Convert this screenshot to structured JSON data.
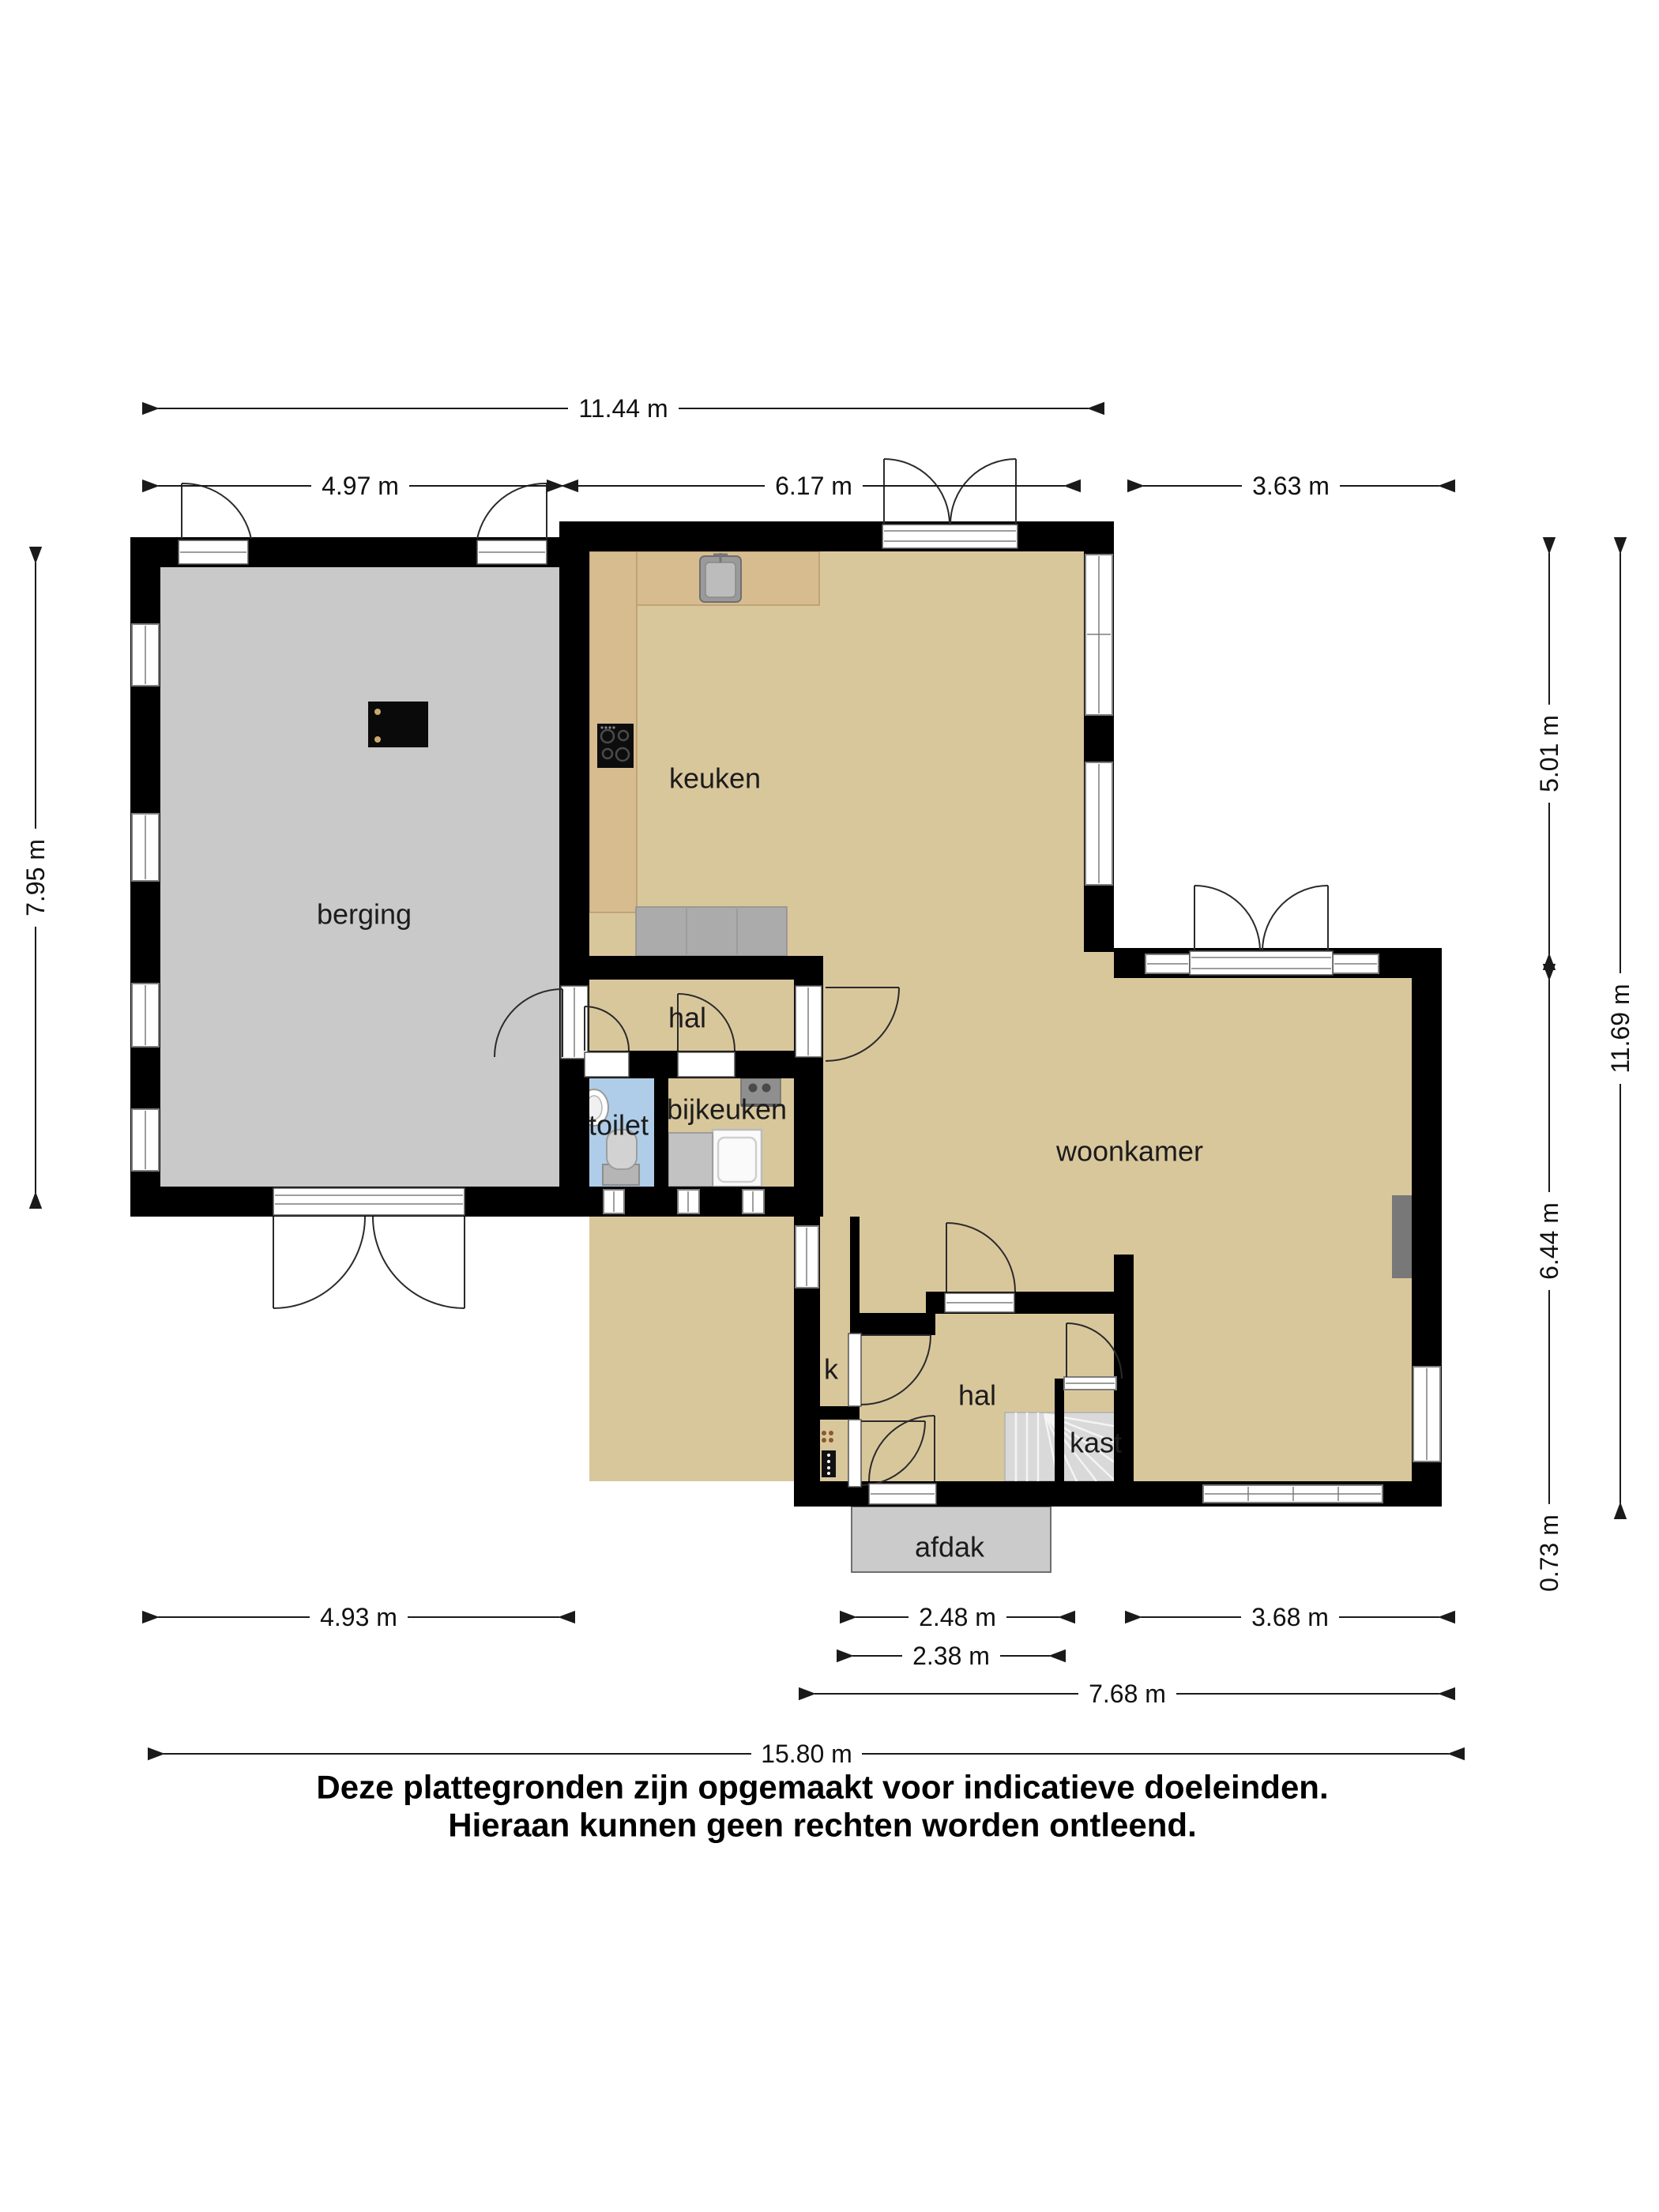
{
  "plan": {
    "type": "floor-plan",
    "language": "nl"
  },
  "rooms": {
    "berging": {
      "label": "berging"
    },
    "keuken": {
      "label": "keuken"
    },
    "hal_boven": {
      "label": "hal"
    },
    "toilet": {
      "label": "toilet"
    },
    "bijkeuken": {
      "label": "bijkeuken"
    },
    "woonkamer": {
      "label": "woonkamer"
    },
    "meterkast": {
      "label": "k"
    },
    "hal_onder": {
      "label": "hal"
    },
    "kast": {
      "label": "kast"
    },
    "afdak": {
      "label": "afdak"
    }
  },
  "dimensions": {
    "top_total": "11.44 m",
    "top_berging": "4.97 m",
    "top_keuken": "6.17 m",
    "top_rechts": "3.63 m",
    "left_berging": "7.95 m",
    "right_keuken": "5.01 m",
    "right_woonkamer": "6.44 m",
    "right_uitbouw": "0.73 m",
    "right_total": "11.69 m",
    "bottom_berging": "4.93 m",
    "bottom_entree": "2.48 m",
    "bottom_raam": "3.68 m",
    "bottom_afdak": "2.38 m",
    "bottom_span": "7.68 m",
    "bottom_total": "15.80 m"
  },
  "disclaimer": {
    "line1": "Deze plattegronden zijn opgemaakt voor indicatieve doeleinden.",
    "line2": "Hieraan kunnen geen rechten worden ontleend."
  },
  "colors": {
    "wall": "#000000",
    "floor_main": "#D9C79C",
    "floor_berging": "#C9C9C9",
    "floor_toilet": "#AFCDE8",
    "counter_wood": "#D7BC8F",
    "cabinet_gray": "#ABABAB",
    "stairs_gray": "#D9D9D9",
    "afdak_gray": "#CBCBCB"
  }
}
